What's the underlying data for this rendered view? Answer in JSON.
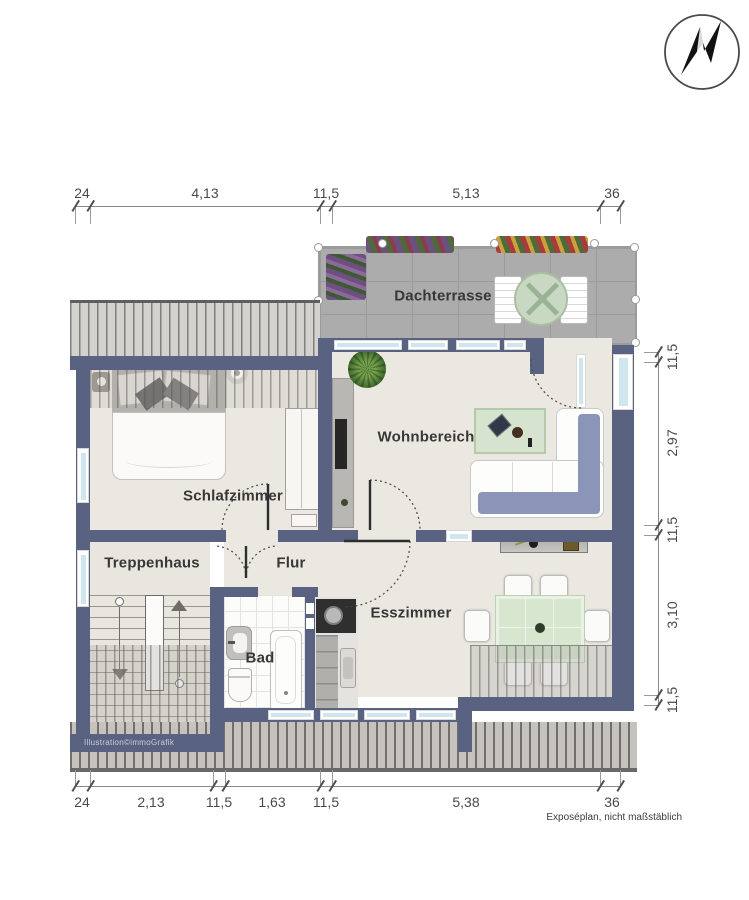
{
  "page": {
    "footer_note": "Exposéplan, nicht maßstäblich",
    "credit": "Illustration©immoGrafik"
  },
  "compass": {
    "direction": "N"
  },
  "rooms": {
    "dachterrasse": "Dachterrasse",
    "wohnbereich": "Wohnbereich",
    "schlafzimmer": "Schlafzimmer",
    "treppenhaus": "Treppenhaus",
    "flur": "Flur",
    "bad": "Bad",
    "esszimmer": "Esszimmer"
  },
  "dimensions": {
    "top": [
      "24",
      "4,13",
      "11,5",
      "5,13",
      "36"
    ],
    "right": [
      "11,5",
      "2,97",
      "11,5",
      "3,10",
      "11,5"
    ],
    "bottom": [
      "24",
      "2,13",
      "11,5",
      "1,63",
      "11,5",
      "5,38",
      "36"
    ]
  },
  "colors": {
    "wall": "#5a6282",
    "floor": "#eae8e1",
    "terrace_tile": "#acacac",
    "glass": "#cfe6ee",
    "sofa_cushion": "#8b95b7",
    "table_green": "#d6e6cf"
  }
}
